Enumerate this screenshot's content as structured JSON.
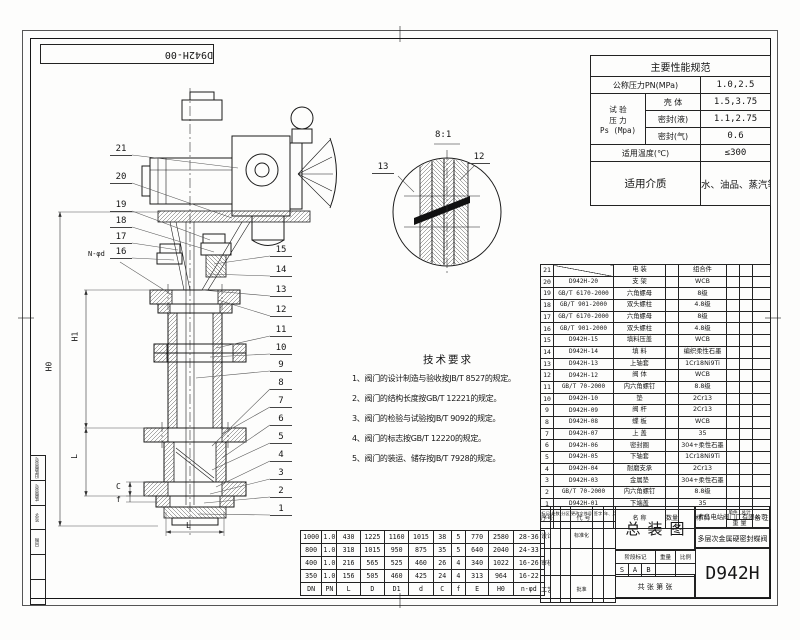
{
  "corner_code": "D942H-00",
  "spec_table": {
    "title": "主要性能规范",
    "pn_label": "公称压力PN(MPa)",
    "pn_value": "1.0,2.5",
    "test_label_top": "试 验",
    "test_label_mid": "压 力",
    "test_label_bot": "Ps (Mpa)",
    "shell_label": "壳 体",
    "shell_value": "1.5,3.75",
    "seal_liquid_label": "密封(液)",
    "seal_liquid_value": "1.1,2.75",
    "seal_gas_label": "密封(气)",
    "seal_gas_value": "0.6",
    "temp_label": "适用温度(℃)",
    "temp_value": "≤300",
    "medium_label": "适用介质",
    "medium_value": "水、油品、蒸汽等"
  },
  "tech_requirements": {
    "title": "技术要求",
    "items": [
      "1、阀门的设计制造与验收按JB/T 8527的规定。",
      "2、阀门的结构长度按GB/T 12221的规定。",
      "3、阀门的检验与试验按JB/T 9092的规定。",
      "4、阀门的标志按GB/T 12220的规定。",
      "5、阀门的装运、储存按JB/T 7928的规定。"
    ]
  },
  "parts_table": {
    "headers": {
      "seq": "序号",
      "code": "代 号",
      "name": "名 称",
      "qty": "数量",
      "material": "材 料",
      "unit": "单件",
      "total": "总计",
      "weight": "重 量",
      "remark": "备 注"
    },
    "rows": [
      {
        "seq": "21",
        "code": "",
        "name": "电 装",
        "qty": "",
        "material": "组合件"
      },
      {
        "seq": "20",
        "code": "D942H-20",
        "name": "支 架",
        "qty": "",
        "material": "WCB"
      },
      {
        "seq": "19",
        "code": "GB/T 6170-2000",
        "name": "六角螺母",
        "qty": "",
        "material": "8级"
      },
      {
        "seq": "18",
        "code": "GB/T 901-2000",
        "name": "双头螺柱",
        "qty": "",
        "material": "4.8级"
      },
      {
        "seq": "17",
        "code": "GB/T 6170-2000",
        "name": "六角螺母",
        "qty": "",
        "material": "8级"
      },
      {
        "seq": "16",
        "code": "GB/T 901-2000",
        "name": "双头螺柱",
        "qty": "",
        "material": "4.8级"
      },
      {
        "seq": "15",
        "code": "D942H-15",
        "name": "填料压盖",
        "qty": "",
        "material": "WCB"
      },
      {
        "seq": "14",
        "code": "D942H-14",
        "name": "填 料",
        "qty": "",
        "material": "编织柔性石墨"
      },
      {
        "seq": "13",
        "code": "D942H-13",
        "name": "上轴套",
        "qty": "",
        "material": "1Cr18Ni9Ti"
      },
      {
        "seq": "12",
        "code": "D942H-12",
        "name": "阀 体",
        "qty": "",
        "material": "WCB"
      },
      {
        "seq": "11",
        "code": "GB/T 70-2000",
        "name": "内六角螺钉",
        "qty": "",
        "material": "8.8级"
      },
      {
        "seq": "10",
        "code": "D942H-10",
        "name": "垫",
        "qty": "",
        "material": "2Cr13"
      },
      {
        "seq": "9",
        "code": "D942H-09",
        "name": "阀 杆",
        "qty": "",
        "material": "2Cr13"
      },
      {
        "seq": "8",
        "code": "D942H-08",
        "name": "蝶 板",
        "qty": "",
        "material": "WCB"
      },
      {
        "seq": "7",
        "code": "D942H-07",
        "name": "上 盖",
        "qty": "",
        "material": "35"
      },
      {
        "seq": "6",
        "code": "D942H-06",
        "name": "密封圈",
        "qty": "",
        "material": "304+柔性石墨"
      },
      {
        "seq": "5",
        "code": "D942H-05",
        "name": "下轴套",
        "qty": "",
        "material": "1Cr18Ni9Ti"
      },
      {
        "seq": "4",
        "code": "D942H-04",
        "name": "耐磨支承",
        "qty": "",
        "material": "2Cr13"
      },
      {
        "seq": "3",
        "code": "D942H-03",
        "name": "金属垫",
        "qty": "",
        "material": "304+柔性石墨"
      },
      {
        "seq": "2",
        "code": "GB/T 70-2000",
        "name": "内六角螺钉",
        "qty": "",
        "material": "8.8级"
      },
      {
        "seq": "1",
        "code": "D942H-01",
        "name": "下端盖",
        "qty": "",
        "material": "35"
      }
    ]
  },
  "dim_table": {
    "headers": [
      "DN",
      "PN",
      "L",
      "D",
      "D1",
      "d",
      "C",
      "f",
      "E",
      "H0",
      "n-φd"
    ],
    "rows": [
      [
        "1000",
        "1.0",
        "430",
        "1225",
        "1160",
        "1015",
        "38",
        "5",
        "770",
        "2580",
        "28-36"
      ],
      [
        "800",
        "1.0",
        "318",
        "1015",
        "950",
        "875",
        "35",
        "5",
        "640",
        "2040",
        "24-33"
      ],
      [
        "400",
        "1.0",
        "216",
        "565",
        "525",
        "460",
        "26",
        "4",
        "340",
        "1022",
        "16-26"
      ],
      [
        "350",
        "1.0",
        "156",
        "505",
        "460",
        "425",
        "24",
        "4",
        "313",
        "964",
        "16-22"
      ]
    ]
  },
  "title_block": {
    "drawing_type": "总装图",
    "company": "青岛电站阀门厂有限公司",
    "product_name": "多层次金属硬密封蝶阀",
    "model": "D942H",
    "stage_label": "阶段标记",
    "weight_label": "重量",
    "scale_label": "比例",
    "stage_marks": [
      "S",
      "A",
      "B"
    ],
    "sheet_text": "共  张  第  张",
    "sig_headers": [
      "标记",
      "处数",
      "分区",
      "更改文件号",
      "签字",
      "年、月、日"
    ],
    "sig_rows": [
      [
        "设计",
        "标准化"
      ],
      [
        "审核",
        ""
      ],
      [
        "工艺",
        "批准"
      ]
    ]
  },
  "border_labels": [
    "旧底图总号",
    "底图总号",
    "签字",
    "日期"
  ],
  "drawing": {
    "balloons_left": [
      "21",
      "20",
      "19",
      "18",
      "17",
      "16"
    ],
    "balloons_right": [
      "15",
      "14",
      "13",
      "12",
      "11",
      "10",
      "9",
      "8",
      "7",
      "6",
      "5",
      "4",
      "3",
      "2",
      "1"
    ],
    "detail": {
      "scale": "8:1",
      "balloon_a": "13",
      "balloon_b": "12"
    },
    "dims": {
      "h0": "H0",
      "h1": "H1",
      "l_vert": "L",
      "l_bottom": "L",
      "c": "C",
      "f": "f",
      "n_phi": "N-φd"
    }
  }
}
